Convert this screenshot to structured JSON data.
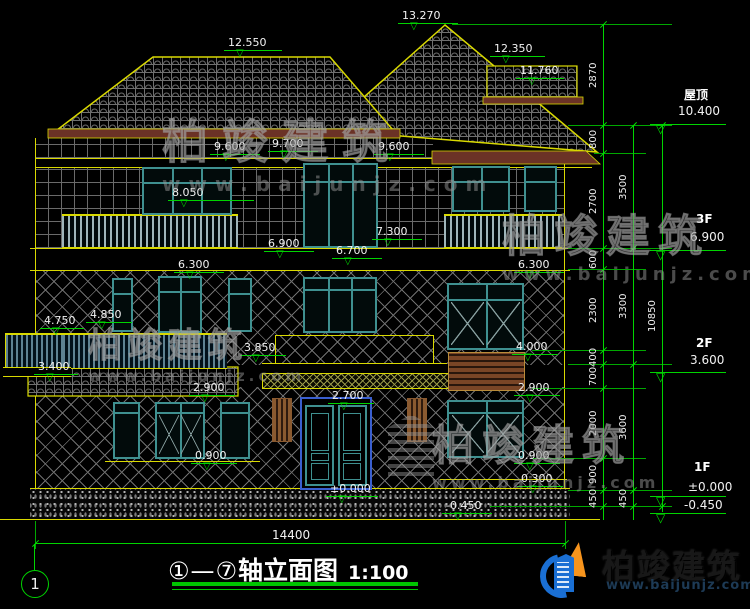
{
  "title": {
    "axes": "①—⑦",
    "name": "轴立面图",
    "scale": "1:100"
  },
  "axis_bubble": "1",
  "bottom_dimension": "14400",
  "colors": {
    "dim_green": "#00d400",
    "outline_yellow": "#d9d900",
    "window_teal": "#3f9090",
    "fascia_brown": "#6b3226",
    "door_blue": "#3a5fd0",
    "text_white": "#f2f2f2"
  },
  "elevation_labels": [
    {
      "t": "13.270",
      "x": 402,
      "y": 10,
      "lw": 60
    },
    {
      "t": "12.550",
      "x": 228,
      "y": 37,
      "lw": 58
    },
    {
      "t": "12.350",
      "x": 494,
      "y": 43,
      "lw": 55
    },
    {
      "t": "11.760",
      "x": 520,
      "y": 65,
      "lw": 48
    },
    {
      "t": "9.600",
      "x": 214,
      "y": 141,
      "lw": 50
    },
    {
      "t": "9.700",
      "x": 272,
      "y": 138,
      "lw": 50
    },
    {
      "t": "9.600",
      "x": 378,
      "y": 141,
      "lw": 50
    },
    {
      "t": "8.050",
      "x": 172,
      "y": 187,
      "lw": 86
    },
    {
      "t": "6.900",
      "x": 268,
      "y": 238,
      "lw": 50
    },
    {
      "t": "7.300",
      "x": 376,
      "y": 226,
      "lw": 50
    },
    {
      "t": "6.700",
      "x": 336,
      "y": 245,
      "lw": 50
    },
    {
      "t": "6.300",
      "x": 178,
      "y": 259,
      "lw": 50
    },
    {
      "t": "6.300",
      "x": 518,
      "y": 259,
      "lw": 50
    },
    {
      "t": "4.850",
      "x": 90,
      "y": 309,
      "lw": 46
    },
    {
      "t": "4.750",
      "x": 44,
      "y": 315,
      "lw": 44
    },
    {
      "t": "3.850",
      "x": 244,
      "y": 342,
      "lw": 46
    },
    {
      "t": "4.000",
      "x": 516,
      "y": 341,
      "lw": 46
    },
    {
      "t": "3.400",
      "x": 38,
      "y": 361,
      "lw": 44
    },
    {
      "t": "2.900",
      "x": 193,
      "y": 382,
      "lw": 46
    },
    {
      "t": "2.900",
      "x": 518,
      "y": 382,
      "lw": 46
    },
    {
      "t": "2.700",
      "x": 332,
      "y": 390,
      "lw": 46
    },
    {
      "t": "0.900",
      "x": 195,
      "y": 450,
      "lw": 46
    },
    {
      "t": "0.900",
      "x": 518,
      "y": 450,
      "lw": 46
    },
    {
      "t": "0.300",
      "x": 521,
      "y": 473,
      "lw": 46
    },
    {
      "t": "±0.000",
      "x": 330,
      "y": 483,
      "lw": 52
    },
    {
      "t": "-0.450",
      "x": 446,
      "y": 500,
      "lw": 50
    }
  ],
  "right_levels": [
    {
      "name": "屋顶",
      "value": "10.400",
      "tx": 684,
      "ny": 86,
      "vy": 104,
      "ly": 124
    },
    {
      "name": "3F",
      "value": "6.900",
      "tx": 696,
      "ny": 212,
      "vy": 230,
      "ly": 250
    },
    {
      "name": "2F",
      "value": "3.600",
      "tx": 696,
      "ny": 336,
      "vy": 353,
      "ly": 372
    },
    {
      "name": "1F",
      "value": "±0.000",
      "tx": 694,
      "ny": 460,
      "vy": 480,
      "ly": 496
    },
    {
      "name": "",
      "value": "-0.450",
      "tx": 690,
      "ny": -99,
      "vy": 498,
      "ly": 513
    }
  ],
  "dim_chains": [
    {
      "x": 603,
      "top": 24,
      "bot": 520,
      "segs": [
        [
          "2870",
          24,
          125
        ],
        [
          "800",
          125,
          153
        ],
        [
          "2700",
          153,
          248
        ],
        [
          "600",
          248,
          269
        ],
        [
          "2300",
          269,
          350
        ],
        [
          "400",
          350,
          364
        ],
        [
          "700",
          364,
          388
        ],
        [
          "2000",
          388,
          458
        ],
        [
          "900",
          458,
          490
        ],
        [
          "450",
          490,
          506
        ]
      ]
    },
    {
      "x": 633,
      "top": 125,
      "bot": 520,
      "segs": [
        [
          "3500",
          125,
          248
        ],
        [
          "3300",
          248,
          364
        ],
        [
          "3600",
          364,
          490
        ],
        [
          "450",
          490,
          506
        ]
      ]
    },
    {
      "x": 662,
      "top": 125,
      "bot": 512,
      "segs": [
        [
          "10850",
          125,
          506
        ]
      ]
    }
  ],
  "ext_lines": [
    {
      "y": 24,
      "x1": 452,
      "x2": 672
    },
    {
      "y": 125,
      "x1": 568,
      "x2": 672
    },
    {
      "y": 153,
      "x1": 594,
      "x2": 646
    },
    {
      "y": 248,
      "x1": 568,
      "x2": 672
    },
    {
      "y": 269,
      "x1": 568,
      "x2": 646
    },
    {
      "y": 350,
      "x1": 532,
      "x2": 646
    },
    {
      "y": 364,
      "x1": 568,
      "x2": 672
    },
    {
      "y": 388,
      "x1": 532,
      "x2": 646
    },
    {
      "y": 458,
      "x1": 532,
      "x2": 646
    },
    {
      "y": 490,
      "x1": 568,
      "x2": 672
    },
    {
      "y": 506,
      "x1": 490,
      "x2": 672
    }
  ],
  "watermarks": [
    {
      "cn": "柏竣建筑",
      "en": "www.baijunjz.com",
      "x": 162,
      "y": 106,
      "cs": 46,
      "cls": 14,
      "es": 20,
      "els": 8
    },
    {
      "cn": "柏竣建筑",
      "en": "www.baijunjz.com",
      "x": 502,
      "y": 200,
      "cs": 44,
      "cls": 8,
      "es": 18,
      "els": 5
    },
    {
      "cn": "柏竣建筑",
      "en": "www.baijunjz.com",
      "x": 88,
      "y": 318,
      "cs": 34,
      "cls": 6,
      "es": 15,
      "els": 4
    },
    {
      "cn": "柏竣建筑",
      "en": "www.baijunjz.com",
      "x": 432,
      "y": 412,
      "cs": 42,
      "cls": 8,
      "es": 16,
      "els": 4
    }
  ],
  "logo": {
    "cn": "柏竣建筑",
    "en": "www.baijunjz.com"
  }
}
